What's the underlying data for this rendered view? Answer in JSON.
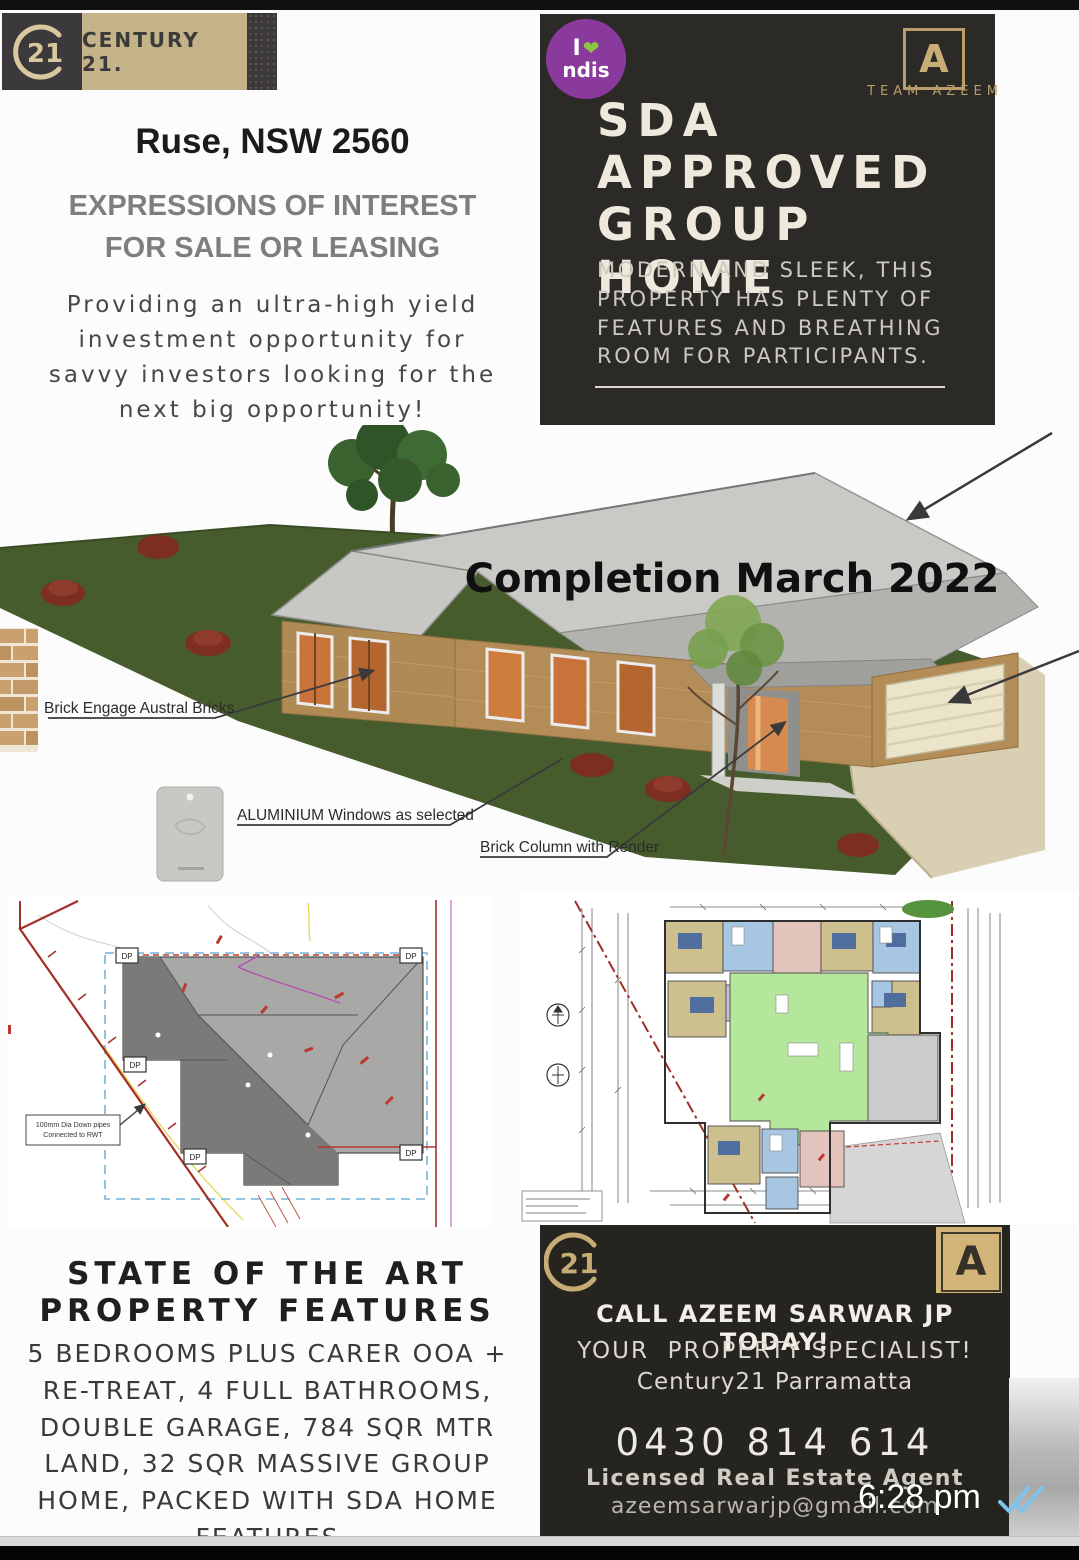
{
  "status_overlay": {
    "time": "6:28 pm",
    "read_receipt_icon": "double-check"
  },
  "header": {
    "c21_monogram": "21",
    "century21_wordmark": "CENTURY 21."
  },
  "left_column": {
    "location_title": "Ruse, NSW 2560",
    "eoi_line1": "EXPRESSIONS OF INTEREST",
    "eoi_line2": "FOR SALE OR LEASING",
    "intro_lines": [
      "Providing an ultra-high yield",
      "investment opportunity for",
      "savvy investors looking for the",
      "next big opportunity!"
    ]
  },
  "hero_panel": {
    "ndis_badge": {
      "line1": "I",
      "heart": "❤",
      "line2": "ndis"
    },
    "team_logo_letter": "A",
    "team_name": "TEAM AZEEM",
    "title_lines": [
      "SDA",
      "APPROVED",
      "GROUP HOME"
    ],
    "subtitle_lines": [
      "MODERN AND SLEEK, THIS",
      "PROPERTY HAS PLENTY OF",
      "FEATURES AND BREATHING",
      "ROOM FOR PARTICIPANTS."
    ]
  },
  "render": {
    "completion_banner": "Completion March 2022",
    "labels": {
      "bricks": "Brick Engage Austral Bricks",
      "windows": "ALUMINIUM Windows as selected",
      "column": "Brick Column with Render"
    }
  },
  "site_plan": {
    "dp_label": "DP",
    "note_line1": "100mm Dia Down pipes",
    "note_line2": "Connected to RWT"
  },
  "features": {
    "heading_line1": "STATE OF THE ART",
    "heading_line2": "PROPERTY FEATURES",
    "body_lines": [
      "5 BEDROOMS PLUS CARER OOA +",
      "RE-TREAT, 4 FULL BATHROOMS,",
      "DOUBLE GARAGE, 784 SQR MTR",
      "LAND, 32 SQR MASSIVE GROUP",
      "HOME, PACKED WITH SDA HOME",
      "FEATURES"
    ]
  },
  "contact_panel": {
    "c21_monogram": "21",
    "team_logo_letter": "A",
    "call_line": "CALL AZEEM SARWAR JP TODAY!",
    "specialist_line": "YOUR  PROPERTY SPECIALIST!",
    "office_line": "Century21 Parramatta",
    "phone": "0430 814 614",
    "license_line": "Licensed Real Estate Agent",
    "email_line": "azeemsarwarjp@gmail.com"
  },
  "colors": {
    "c21_gold": "#c4b288",
    "panel_dark": "#2b2a27",
    "ndis_purple": "#8a3a9c",
    "ndis_green": "#8dc63f",
    "lawn_green": "#475c2d",
    "boundary_red": "#a33028",
    "tick_blue": "#7ec3ec"
  }
}
